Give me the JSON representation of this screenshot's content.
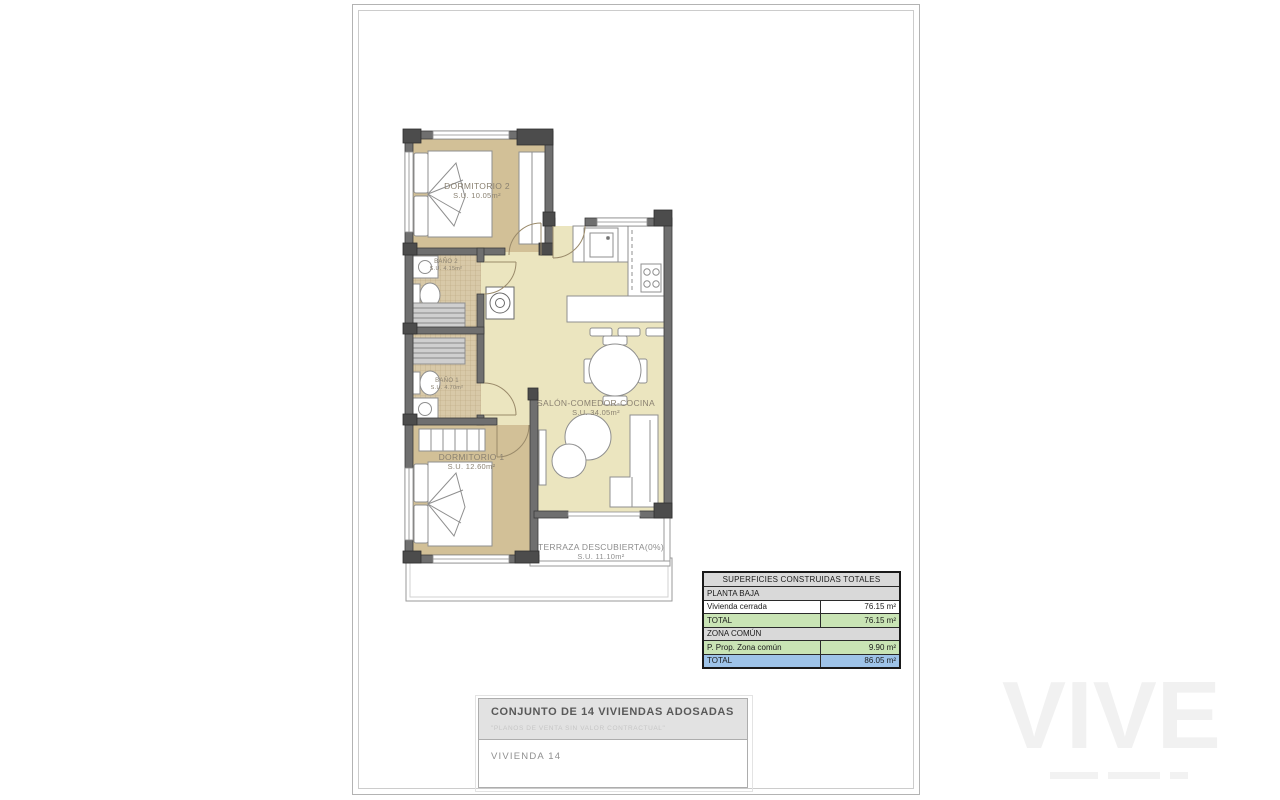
{
  "plan": {
    "rooms": {
      "dormitorio2": {
        "name": "DORMITORIO 2",
        "area": "S.U. 10.05m²"
      },
      "bano2": {
        "name": "BAÑO 2",
        "area": "S.U. 4.15m²"
      },
      "bano1": {
        "name": "BAÑO 1",
        "area": "S.U. 4.70m²"
      },
      "dormitorio1": {
        "name": "DORMITORIO 1",
        "area": "S.U. 12.60m²"
      },
      "salon": {
        "name": "SALÓN-COMEDOR-COCINA",
        "area": "S.U. 34.05m²"
      },
      "terraza": {
        "name": "TERRAZA DESCUBIERTA(0%)",
        "area": "S.U. 11.10m²"
      }
    }
  },
  "surfaces_table": {
    "title": "SUPERFICIES CONSTRUIDAS TOTALES",
    "rows": [
      {
        "label": "PLANTA BAJA",
        "value": ""
      },
      {
        "label": "Vivienda cerrada",
        "value": "76.15 m²"
      },
      {
        "label": "TOTAL",
        "value": "76.15 m²"
      },
      {
        "label": "ZONA COMÚN",
        "value": ""
      },
      {
        "label": "P. Prop. Zona común",
        "value": "9.90 m²"
      },
      {
        "label": "TOTAL",
        "value": "86.05 m²"
      }
    ]
  },
  "title_block": {
    "project": "CONJUNTO DE 14 VIVIENDAS ADOSADAS",
    "disclaimer": "\"PLANOS DE VENTA SIN VALOR CONTRACTUAL\"",
    "unit": "VIVIENDA 14"
  },
  "watermark": {
    "logo": "VIVE"
  },
  "colors": {
    "bedroom_fill": "#d2c097",
    "bath_fill": "#d8c9a8",
    "living_fill": "#ebe5bf",
    "wall": "#6f6f6f",
    "pillar": "#4c4c4c",
    "table_gray": "#d9d9d9",
    "table_green": "#c9e4b5",
    "table_blue": "#9ec3e8"
  }
}
